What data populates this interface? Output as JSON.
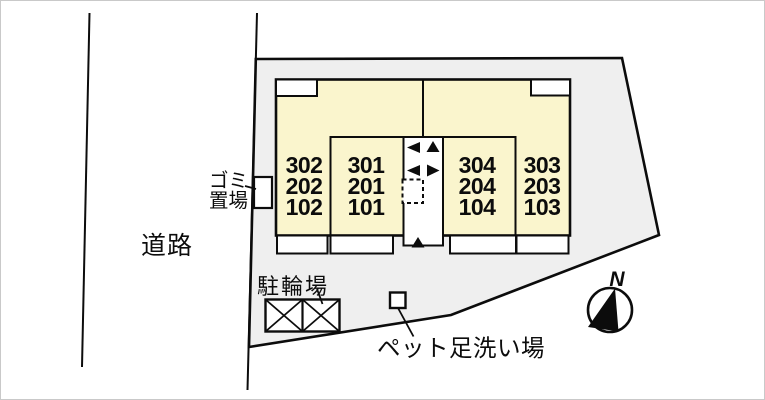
{
  "site": {
    "labels": {
      "road": "道路",
      "garbage": {
        "line1": "ゴミ",
        "line2": "置場"
      },
      "bicycle_parking": "駐輪場",
      "pet_foot_wash": "ペット足洗い場",
      "compass_north": "N"
    },
    "building": {
      "room_columns": [
        {
          "lines": [
            "302",
            "202",
            "102"
          ]
        },
        {
          "lines": [
            "301",
            "201",
            "101"
          ]
        },
        {
          "lines": [
            "304",
            "204",
            "104"
          ]
        },
        {
          "lines": [
            "303",
            "203",
            "103"
          ]
        }
      ]
    },
    "colors": {
      "site_fill": "#efefef",
      "building_fill": "#faf5cd",
      "line": "#0c0c0c",
      "background": "#ffffff"
    }
  }
}
